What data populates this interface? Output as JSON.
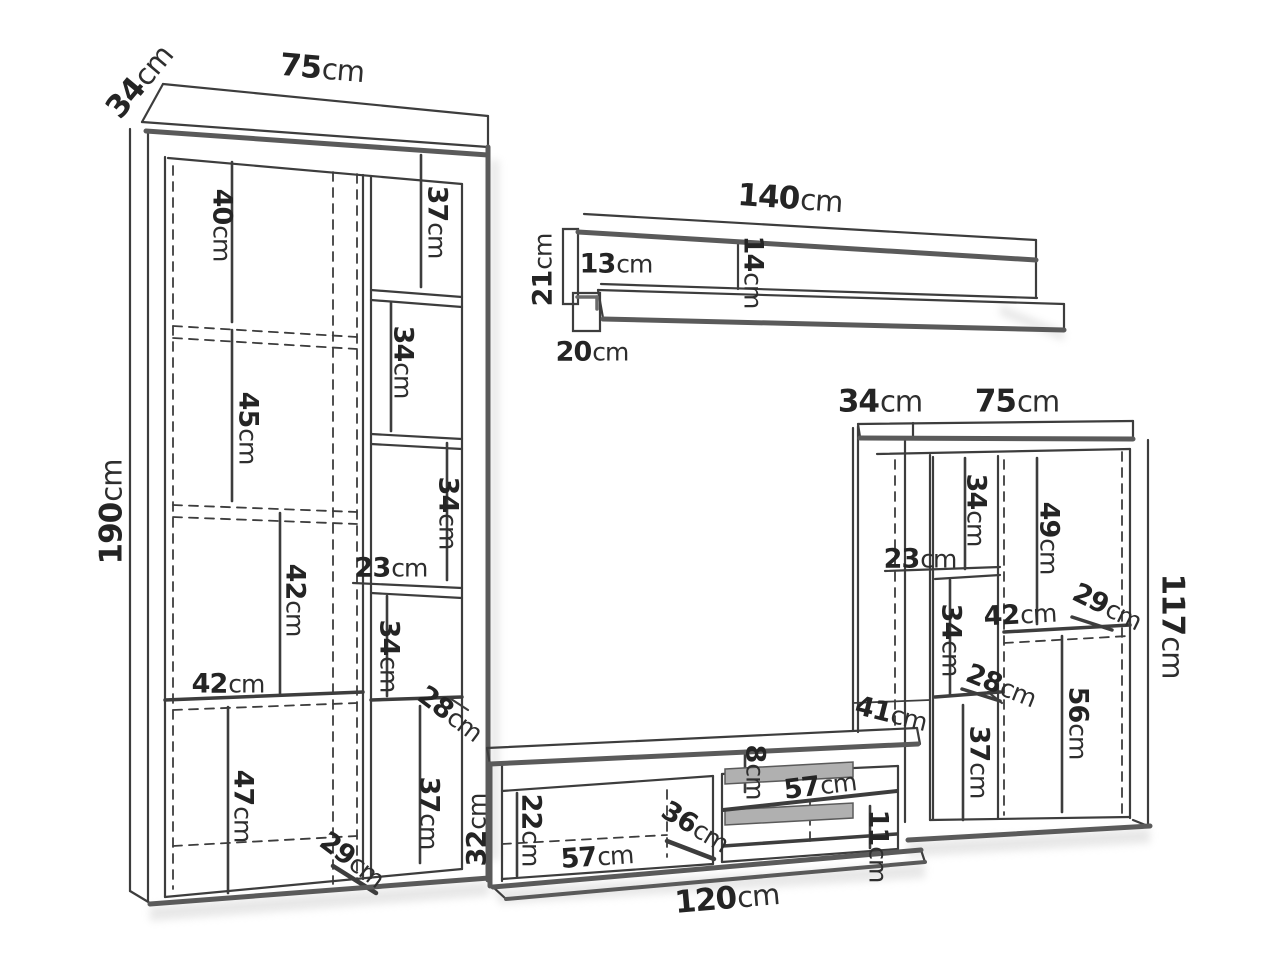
{
  "unit": "cm",
  "left_bookcase": {
    "depth": "34",
    "width": "75",
    "height": "190",
    "inner_left": [
      "40",
      "45",
      "42",
      "47"
    ],
    "shelf_width": "42",
    "inner_right": [
      "37",
      "34",
      "34",
      "23",
      "34",
      "28",
      "37"
    ],
    "base_height": "29"
  },
  "wall_shelf": {
    "width": "140",
    "end_height": "21",
    "panel_height": "13",
    "mid_height": "14",
    "end_depth": "20"
  },
  "right_cabinet": {
    "depth": "34",
    "width": "75",
    "height": "117",
    "inner": [
      "23",
      "34",
      "49",
      "29",
      "42",
      "34",
      "28",
      "37",
      "56"
    ]
  },
  "tv_stand": {
    "depth": "41",
    "height": "32",
    "inner_height": "22",
    "inner_width": "57",
    "inner_depth": "36",
    "top_gap": "8",
    "shelf_width": "57",
    "shelf_gap": "11",
    "width": "120"
  }
}
